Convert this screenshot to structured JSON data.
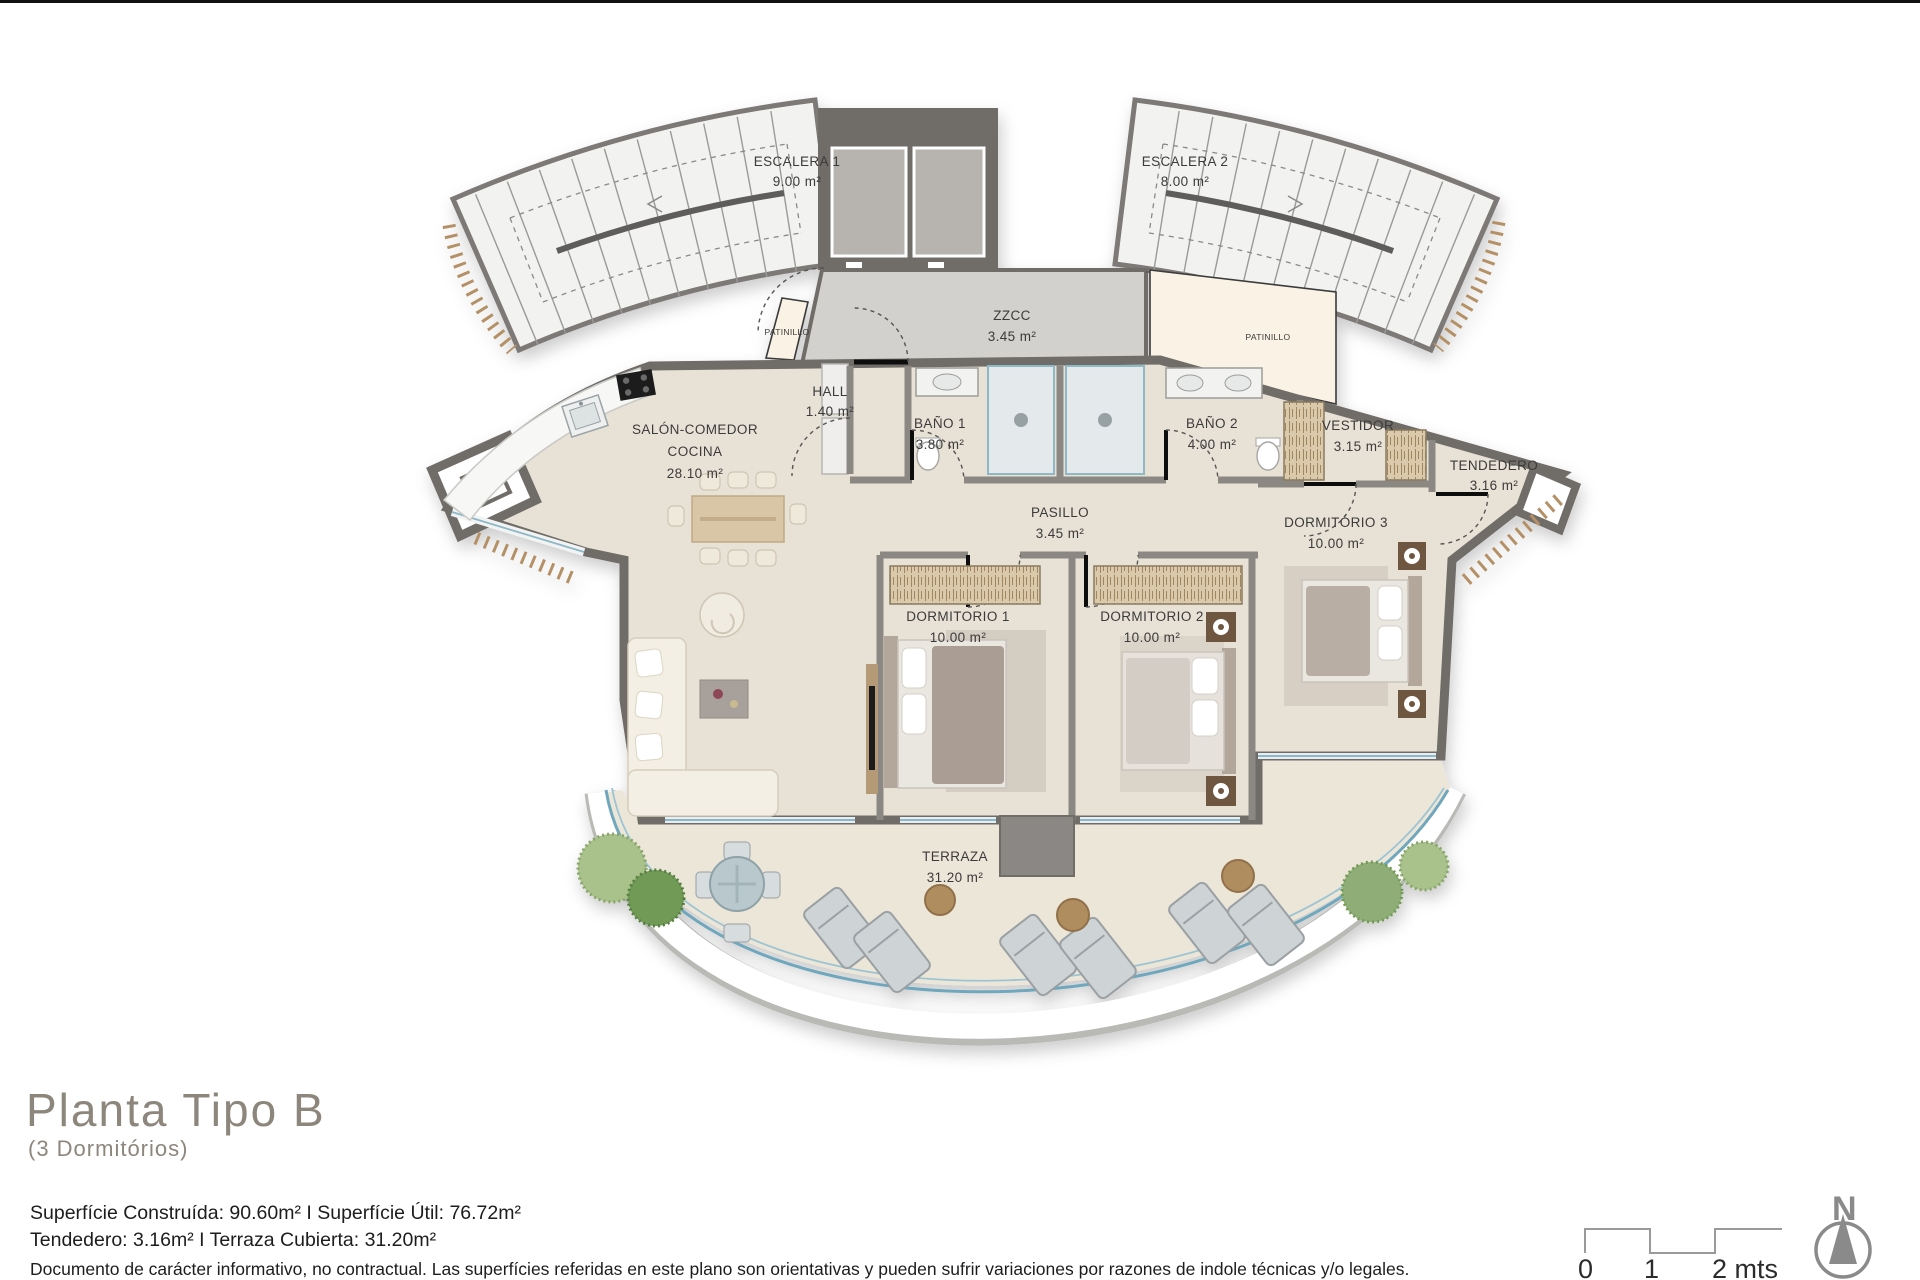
{
  "document": {
    "type": "architectural-floor-plan",
    "title": "Planta Tipo B",
    "subtitle": "(3 Dormitórios)"
  },
  "rooms": {
    "escalera1": {
      "name": "ESCALERA 1",
      "area": "9.00 m²"
    },
    "escalera2": {
      "name": "ESCALERA 2",
      "area": "8.00 m²"
    },
    "zzcc": {
      "name": "ZZCC",
      "area": "3.45 m²"
    },
    "patinillo_left": {
      "name": "PATINILLO"
    },
    "patinillo_right": {
      "name": "PATINILLO"
    },
    "hall": {
      "name": "HALL",
      "area": "1.40 m²"
    },
    "bano1": {
      "name": "BAÑO 1",
      "area": "3.80 m²"
    },
    "bano2": {
      "name": "BAÑO 2",
      "area": "4.00 m²"
    },
    "vestidor": {
      "name": "VESTIDOR",
      "area": "3.15 m²"
    },
    "tendedero": {
      "name": "TENDEDERO",
      "area": "3.16 m²"
    },
    "salon": {
      "name_line1": "SALÓN-COMEDOR",
      "name_line2": "COCINA",
      "area": "28.10 m²"
    },
    "pasillo": {
      "name": "PASILLO",
      "area": "3.45 m²"
    },
    "dormitorio1": {
      "name": "DORMITORIO 1",
      "area": "10.00 m²"
    },
    "dormitorio2": {
      "name": "DORMITORIO 2",
      "area": "10.00 m²"
    },
    "dormitorio3": {
      "name": "DORMITÓRIO 3",
      "area": "10.00 m²"
    },
    "terraza": {
      "name": "TERRAZA",
      "area": "31.20 m²"
    }
  },
  "summary": {
    "line1": "Superfície Construída: 90.60m² I Superfície Útil: 76.72m²",
    "line2": "Tendedero: 3.16m² I Terraza Cubierta: 31.20m²"
  },
  "disclaimer": "Documento de carácter informativo, no contractual. Las superfícies referidas en este plano son orientativas y pueden sufrir variaciones por razones de indole técnicas y/o legales.",
  "scale_bar": {
    "tick0": "0",
    "tick1": "1",
    "tick2": "2 mts"
  },
  "compass": {
    "north_label": "N"
  },
  "palette": {
    "wall": "#6f6c68",
    "wall_light": "#8b8884",
    "floor": "#e8e2d6",
    "terrace_floor": "#ece6d9",
    "zzcc_floor": "#d3d1cd",
    "stairs_floor": "#f2f2f1",
    "patinillo_cream": "#faf3e5",
    "glass_blue": "#6fa7bc",
    "wood": "#b08d5f",
    "wardrobe_tan": "#dbc9ab",
    "plant_green": "#8fae77",
    "plant_green_dark": "#6f9a55",
    "lounger_gray": "#ced3d5",
    "label_text": "#3a3a3a",
    "muted_title": "#8d867c"
  }
}
